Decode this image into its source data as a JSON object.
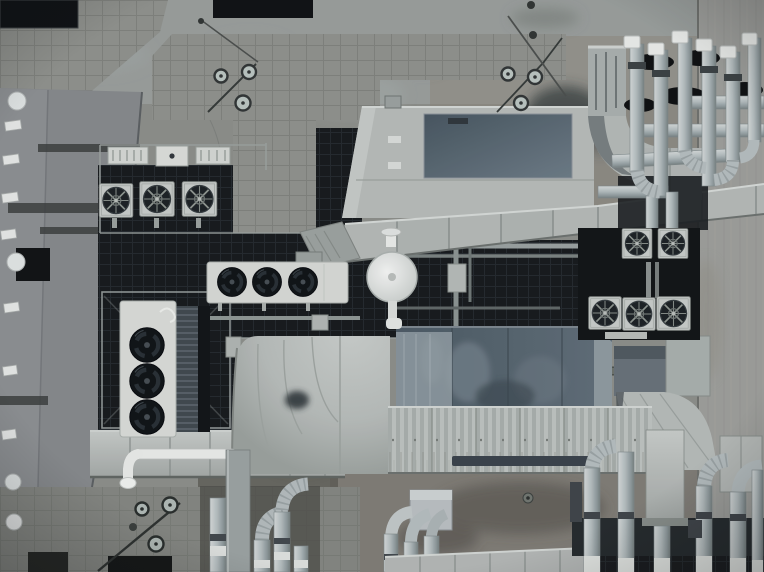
{
  "image": {
    "kind": "aerial drone photograph, top-down (nadir) view",
    "subject": "commercial building rooftop crowded with HVAC mechanical plant",
    "alt": "Top-down drone photograph of a building rooftop packed with HVAC plant: two large air-handling units with sheet-metal ducting, white condenser banks with three black axial fans each, five square fan units on dark plant at the right, clusters of insulated silver pipes with ribbed elbows and white caps, a dark steel-grate equipment platform with guard rails, weathered concrete deck with paver walkways and stains, a lower roof with vents along the left edge and a bare concrete strip down the right edge."
  },
  "palette": {
    "concrete": "#8b8d88",
    "concrete_light": "#9ba19f",
    "concrete_warm": "#8b857a",
    "concrete_stain": "#6d6a62",
    "wall": "#9c9d98",
    "tile": "#8e908b",
    "tile_dark": "#83857f",
    "tile_line": "#6e716c",
    "roof_left": "#85888a",
    "platform": "#15181b",
    "grate_line": "#262b2f",
    "rail": "#9ba19e",
    "metal": "#b5bab7",
    "metal_light": "#c9cdca",
    "metal_edge": "#878d8a",
    "white": "#e9ebe8",
    "panel_dark": "#4e5c66",
    "panel_mottle": "#7e8b93",
    "pipe": "#b0b9ba",
    "pipe_light": "#d3d8d7",
    "pipe_shadow": "#76807f",
    "black": "#0d1012",
    "fan_dark": "#14191c"
  },
  "scene": {
    "areas": [
      {
        "name": "adjacent-lower-roof",
        "desc": "Narrow lower roof strip along the left edge with round dome vents, white slot vents, dark joist shadows and a dark access hatch"
      },
      {
        "name": "concrete-deck",
        "desc": "Weathered grey concrete roof deck with stains, drains and hairline cracks"
      },
      {
        "name": "paver-walkways",
        "desc": "Square concrete paver walkways: L-shaped band top-centre, corner patch top-left, apron bottom-left with dark openings"
      },
      {
        "name": "skylights",
        "desc": "Two dark roof openings along the top edge"
      },
      {
        "name": "equipment-platform",
        "desc": "Dark steel-grate equipment platform with light guard rails holding junction boxes and fan condensers"
      },
      {
        "name": "ahu-upper",
        "desc": "Large air-handling unit with dark blue-grey access panel feeding a segmented duct that runs to the right edge past a smooth elbow"
      },
      {
        "name": "ahu-lower",
        "desc": "Second air-handling unit with dark blue-grey mottled top joined to a corrugated duct run, radius bend on the left, fanned transition on the right"
      },
      {
        "name": "condenser-vertical",
        "desc": "White condenser bank with three black axial fans mounted vertically on the platform"
      },
      {
        "name": "condenser-horizontal",
        "desc": "White condenser bank with three black axial fans lying across the dark service trench"
      },
      {
        "name": "fan-units-right",
        "desc": "Five square condenser fan units in two rows on dark plant at the right"
      },
      {
        "name": "round-roof-fan",
        "desc": "Small white circular rooftop fan on a stub pipe at centre"
      },
      {
        "name": "pipe-racks",
        "desc": "Clusters of insulated pipes with ribbed elbows, white end caps and black saddle clamps: top-right farm, bottom-centre risers, bottom-right risers on a dark support rail"
      },
      {
        "name": "concrete-wall-right",
        "desc": "Poured concrete strip down the right edge with vertical form streaks"
      },
      {
        "name": "lightning-rods",
        "desc": "Three small assemblies of linked rings with thin diagonal rods"
      }
    ],
    "equipment_counts": {
      "air_handling_units": 2,
      "small_rooftop_boxes": 3,
      "square_fan_condensers_center": 3,
      "square_fan_condensers_right_top_row": 2,
      "square_fan_condensers_right_bottom_row": 3,
      "black_fans_horizontal_condenser": 3,
      "black_fans_vertical_condenser": 3,
      "round_white_roof_fan": 1,
      "vertical_pipe_risers_top_right": 6,
      "vertical_pipe_risers_bottom_center": 4,
      "vertical_pipe_risers_bottom_right": 6,
      "round_roof_vents_left_building": 4,
      "slot_vents_left_building": 7,
      "dark_skylights": 2,
      "lightning_rod_clusters": 3
    }
  }
}
